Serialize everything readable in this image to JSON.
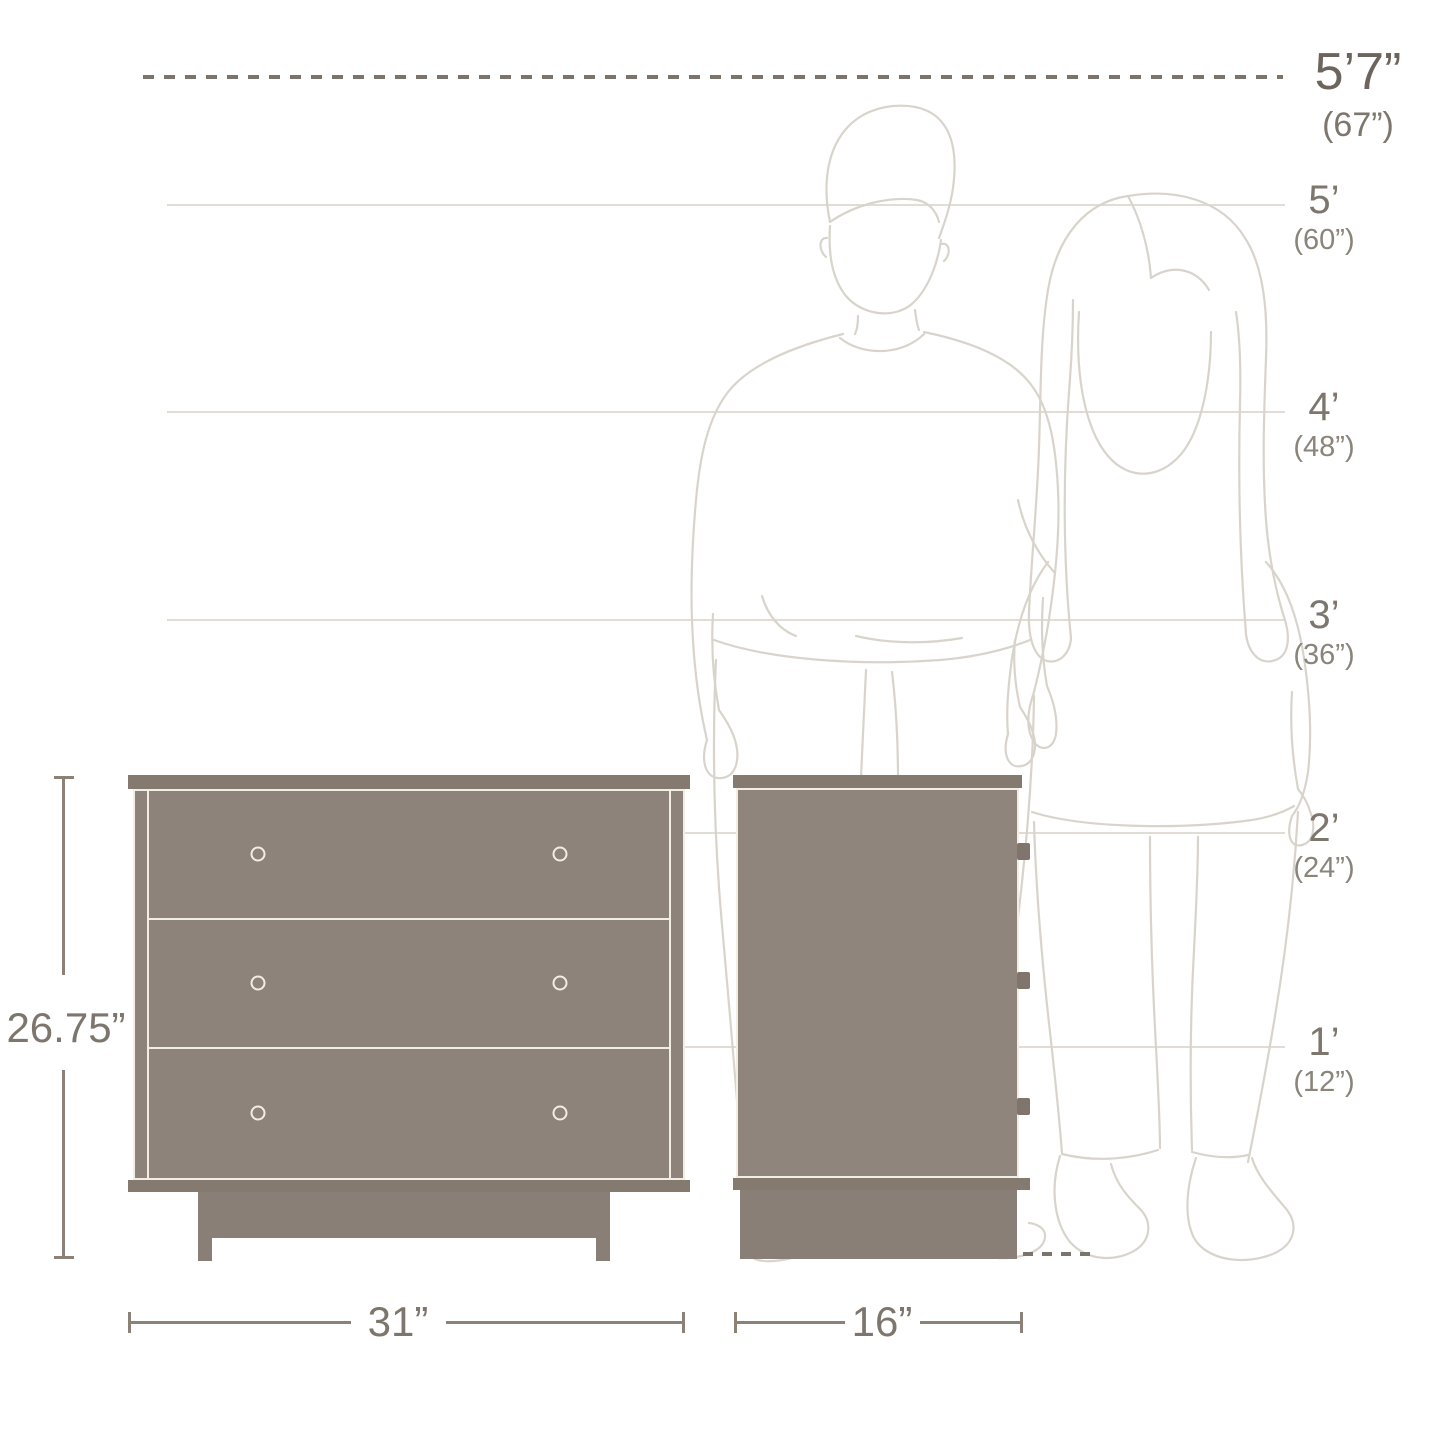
{
  "diagram": {
    "subject": "3-drawer dresser scale diagram with front and side views and two human outlines",
    "views": [
      "front",
      "side"
    ],
    "drawer_count": 3,
    "knobs_per_drawer": 2,
    "side_pull_count": 3
  },
  "height_markers": [
    {
      "feet": "5’7”",
      "inches": "(67”)",
      "value_in": 67,
      "emphasized": true
    },
    {
      "feet": "5’",
      "inches": "(60”)",
      "value_in": 60,
      "emphasized": false
    },
    {
      "feet": "4’",
      "inches": "(48”)",
      "value_in": 48,
      "emphasized": false
    },
    {
      "feet": "3’",
      "inches": "(36”)",
      "value_in": 36,
      "emphasized": false
    },
    {
      "feet": "2’",
      "inches": "(24”)",
      "value_in": 24,
      "emphasized": false
    },
    {
      "feet": "1’",
      "inches": "(12”)",
      "value_in": 12,
      "emphasized": false
    }
  ],
  "dimensions": {
    "height": {
      "label": "26.75”",
      "value_in": 26.75
    },
    "width": {
      "label": "31”",
      "value_in": 31
    },
    "depth": {
      "label": "16”",
      "value_in": 16
    }
  },
  "colors": {
    "furniture_fill": "#8e837a",
    "furniture_trim": "#857a70",
    "outline_cream": "#f2ede5",
    "dimension_line": "#8c8176",
    "label_text": "#7d766d",
    "emphasis_text": "#6b655d",
    "reference_line": "#e1ddd5",
    "sketch_line": "#d9d4cb"
  }
}
